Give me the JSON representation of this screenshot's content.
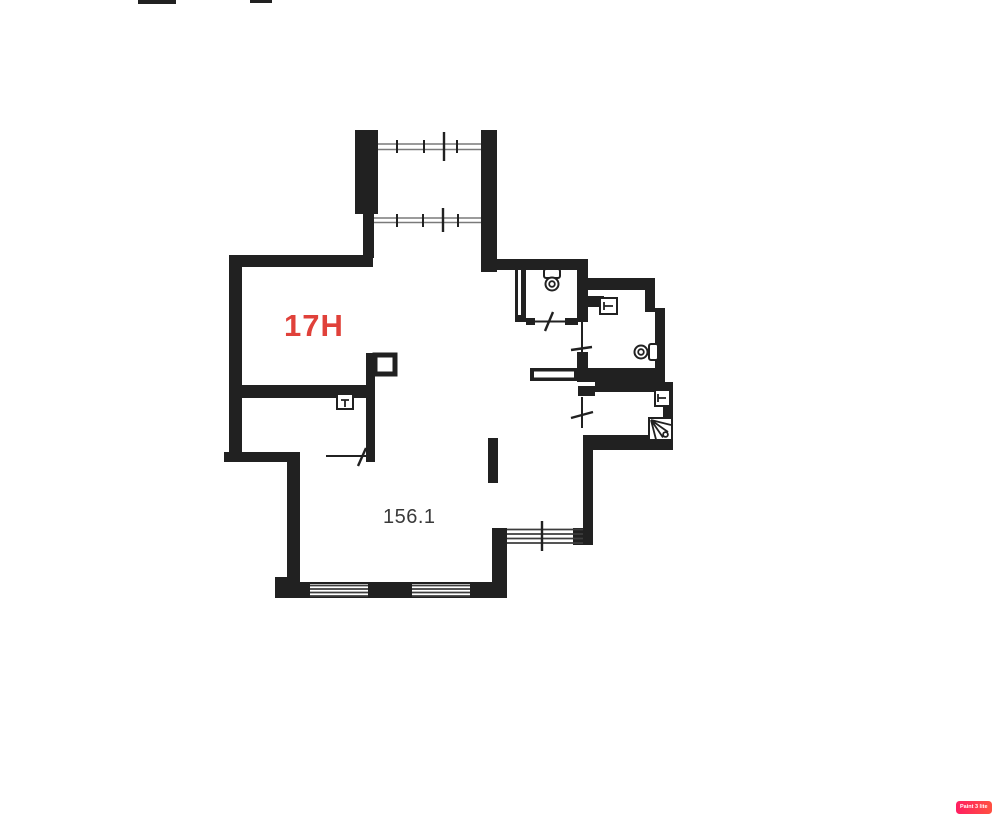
{
  "page": {
    "background_color": "#ffffff"
  },
  "floor_plan": {
    "unit_label": "17H",
    "area_label": "156.1",
    "fixtures": [
      "toilet-icon",
      "toilet-icon",
      "sink-icon",
      "sink-icon",
      "sink-icon",
      "shower-tray-icon",
      "vent-shaft-icon"
    ],
    "windows": [
      "bay-window-top",
      "bay-window-bottom",
      "bottom-wall-window-left",
      "bottom-wall-window-right",
      "side-window-bottom-right"
    ]
  },
  "watermark": {
    "label": "Paint 3 lite"
  },
  "colors": {
    "wall": "#212121",
    "window_line": "#7a7a7a",
    "window_hatch": "#3d3d3d",
    "unit_label": "#e0413a",
    "area_label": "#3a3a3a",
    "badge_start": "#ff1f62",
    "badge_end": "#ff5040",
    "badge_text": "#ffffff"
  }
}
